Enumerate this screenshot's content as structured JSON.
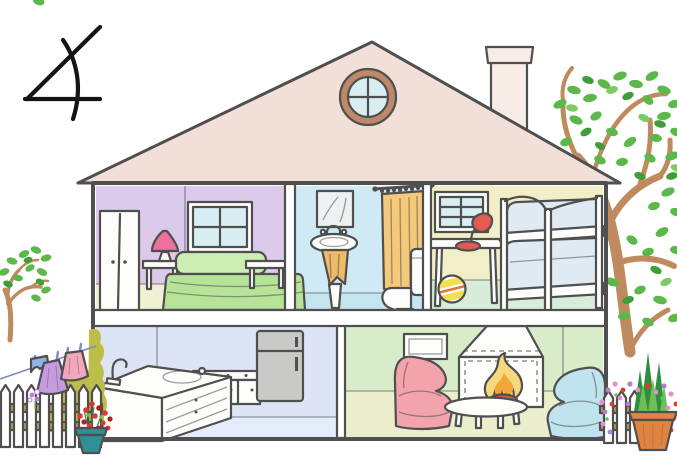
{
  "annotation": {
    "numeral": "4"
  },
  "scene": {
    "type": "cutaway-house-illustration",
    "house": {
      "roof": [
        "round-attic-window",
        "chimney"
      ],
      "upper_rooms": [
        "bedroom",
        "bathroom",
        "children-bedroom"
      ],
      "lower_rooms": [
        "kitchen",
        "living-room"
      ],
      "bedroom_items": [
        "wardrobe",
        "window",
        "table-lamp",
        "nightstand",
        "double-bed",
        "bench"
      ],
      "bathroom_items": [
        "mirror",
        "washbasin",
        "towel",
        "shower-curtain",
        "toilet"
      ],
      "children_bedroom_items": [
        "window",
        "desk",
        "desk-lamp",
        "ball",
        "bunk-bed"
      ],
      "kitchen_items": [
        "sink-counter",
        "faucet",
        "cabinet",
        "refrigerator"
      ],
      "living_room_items": [
        "wall-vent",
        "fireplace",
        "fire",
        "pink-armchair",
        "blue-armchair",
        "coffee-table"
      ]
    },
    "outdoors_left": [
      "small-tree",
      "clothesline",
      "blue-shorts",
      "purple-skirt",
      "pink-dress",
      "bush",
      "picket-fence",
      "teal-flower-pot",
      "red-flowers"
    ],
    "outdoors_right": [
      "large-tree",
      "picket-fence",
      "terracotta-planter",
      "tall-plants",
      "mixed-flowers"
    ]
  },
  "colors": {
    "outline": "#4f4f4f",
    "glyph": "#141414",
    "roof": "#f2e0d8",
    "chimney": "#f7ece6",
    "frame_brown": "#c0886a",
    "glass": "#d8eef3",
    "furn_white": "#fdfdfc",
    "mirror_gray": "#eef1f2",
    "bedroom_wall": "#dccaec",
    "bedroom_floor": "#f0f0d3",
    "bath_wall": "#cfeaf4",
    "bath_floor": "#c4e4f0",
    "kids_wall": "#f2efc8",
    "kids_floor": "#d7ecd9",
    "kitchen_wall": "#dce4f6",
    "kitchen_floor": "#e4ebfa",
    "living_wall": "#d9ecc9",
    "living_floor": "#ebeecd",
    "bed_green": "#b7e398",
    "bed_green_light": "#cdeeb3",
    "lamp_pink": "#ef6f9f",
    "towel_orange": "#edba67",
    "curtain_orange": "#f5c97a",
    "mattress_blue": "#dfeaf3",
    "desk_lamp_red": "#e25a50",
    "ball_yellow": "#f2e052",
    "ball_stripe": "#e8762f",
    "fridge_gray": "#c9cac8",
    "chair_pink": "#f2a3ab",
    "chair_blue": "#bfe4ee",
    "flame_yellow": "#f8d87c",
    "flame_orange": "#f0a738",
    "flame_red": "#e15545",
    "trunk_brown": "#bf8a5e",
    "leaf_green": "#5cb84a",
    "leaf_green_dark": "#3f9e37",
    "leaf_green_light": "#7ecb63",
    "bush_olive": "#bdbd49",
    "rail_tan": "#b09a52",
    "cloth_blue": "#8fb4e6",
    "cloth_purple": "#c59ade",
    "cloth_pink": "#f3a7bc",
    "pot_teal": "#2e8f96",
    "flower_red": "#dc3a2c",
    "flower_dark_red": "#a8251c",
    "pot_clay": "#e08440",
    "plant_dark": "#2f8f3f",
    "plant_light": "#6fbf59",
    "flower_pink": "#e68fd0",
    "flower_violet": "#b57fd6",
    "line_blue": "#8089c0"
  }
}
